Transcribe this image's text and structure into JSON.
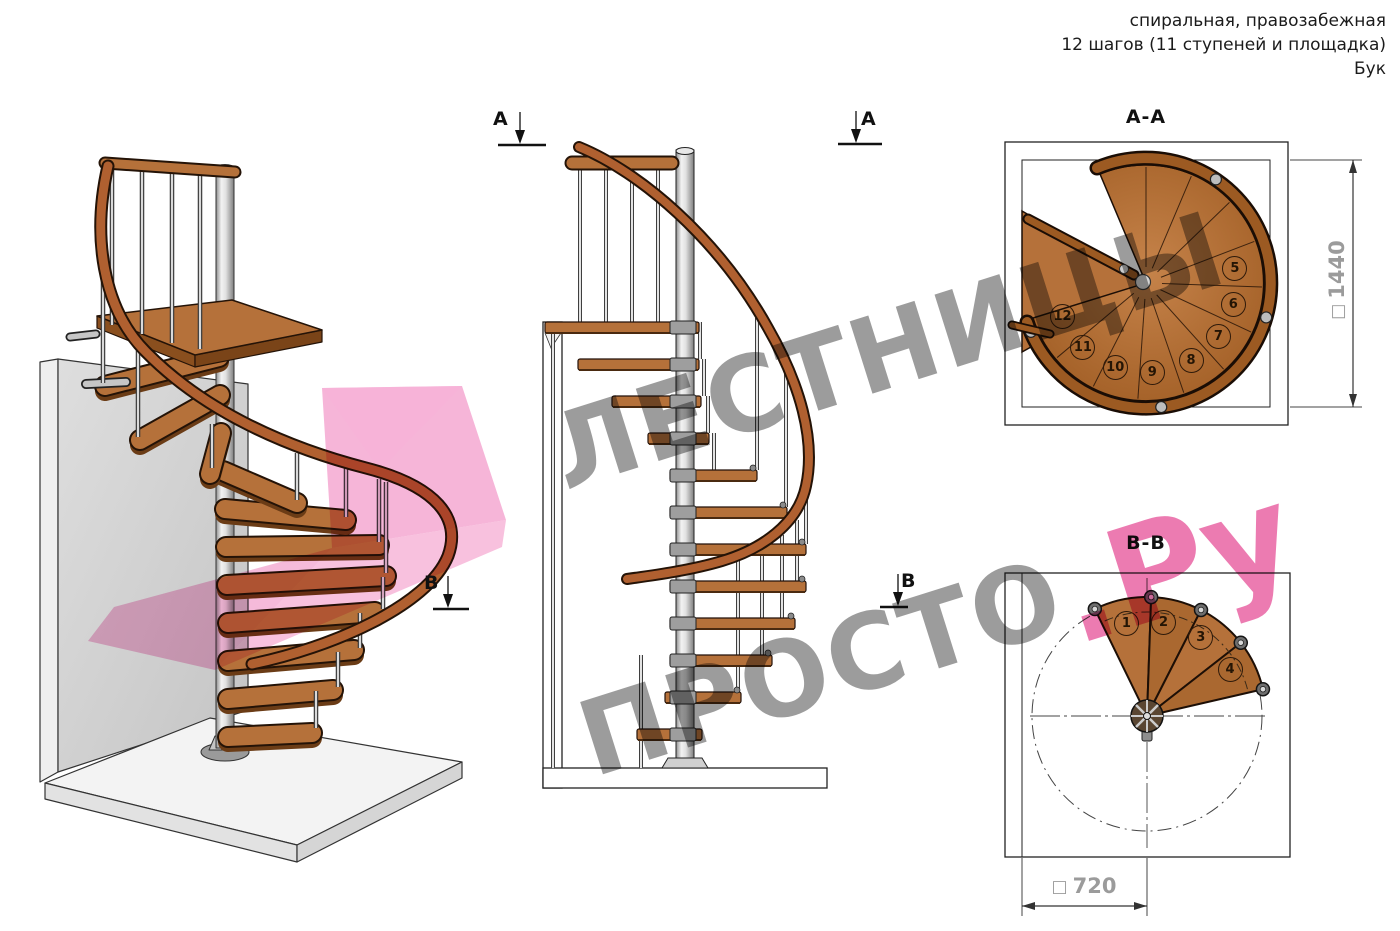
{
  "header": {
    "type_line": "спиральная, правозабежная",
    "steps_line": "12 шагов (11 ступеней и площадка)",
    "material_line": "Бук"
  },
  "views": {
    "aa": {
      "label": "А-А",
      "dim_symbol": "□",
      "dim_value": "1440",
      "step_numbers": [
        "5",
        "6",
        "7",
        "8",
        "9",
        "10",
        "11",
        "12"
      ]
    },
    "bb": {
      "label": "В-В",
      "dim_symbol": "□",
      "dim_value": "720",
      "step_numbers": [
        "1",
        "2",
        "3",
        "4"
      ]
    }
  },
  "section_markers": {
    "a": "А",
    "b": "В"
  },
  "watermark": {
    "word1": "ЛЕСТНИЦЫ",
    "word2": "ПРОСТО",
    "word2_suffix": ".Ру"
  },
  "colors": {
    "wood": "#b5713a",
    "wood_dark": "#7a4418",
    "outline": "#1c1008",
    "metal": "#c9c9c9",
    "wall_gray": "#d6d6d6",
    "dim_text": "#9b9b9b",
    "watermark_gray": "#949494",
    "watermark_pink": "#e75a9e",
    "overlay_pink": "#f292c5"
  }
}
